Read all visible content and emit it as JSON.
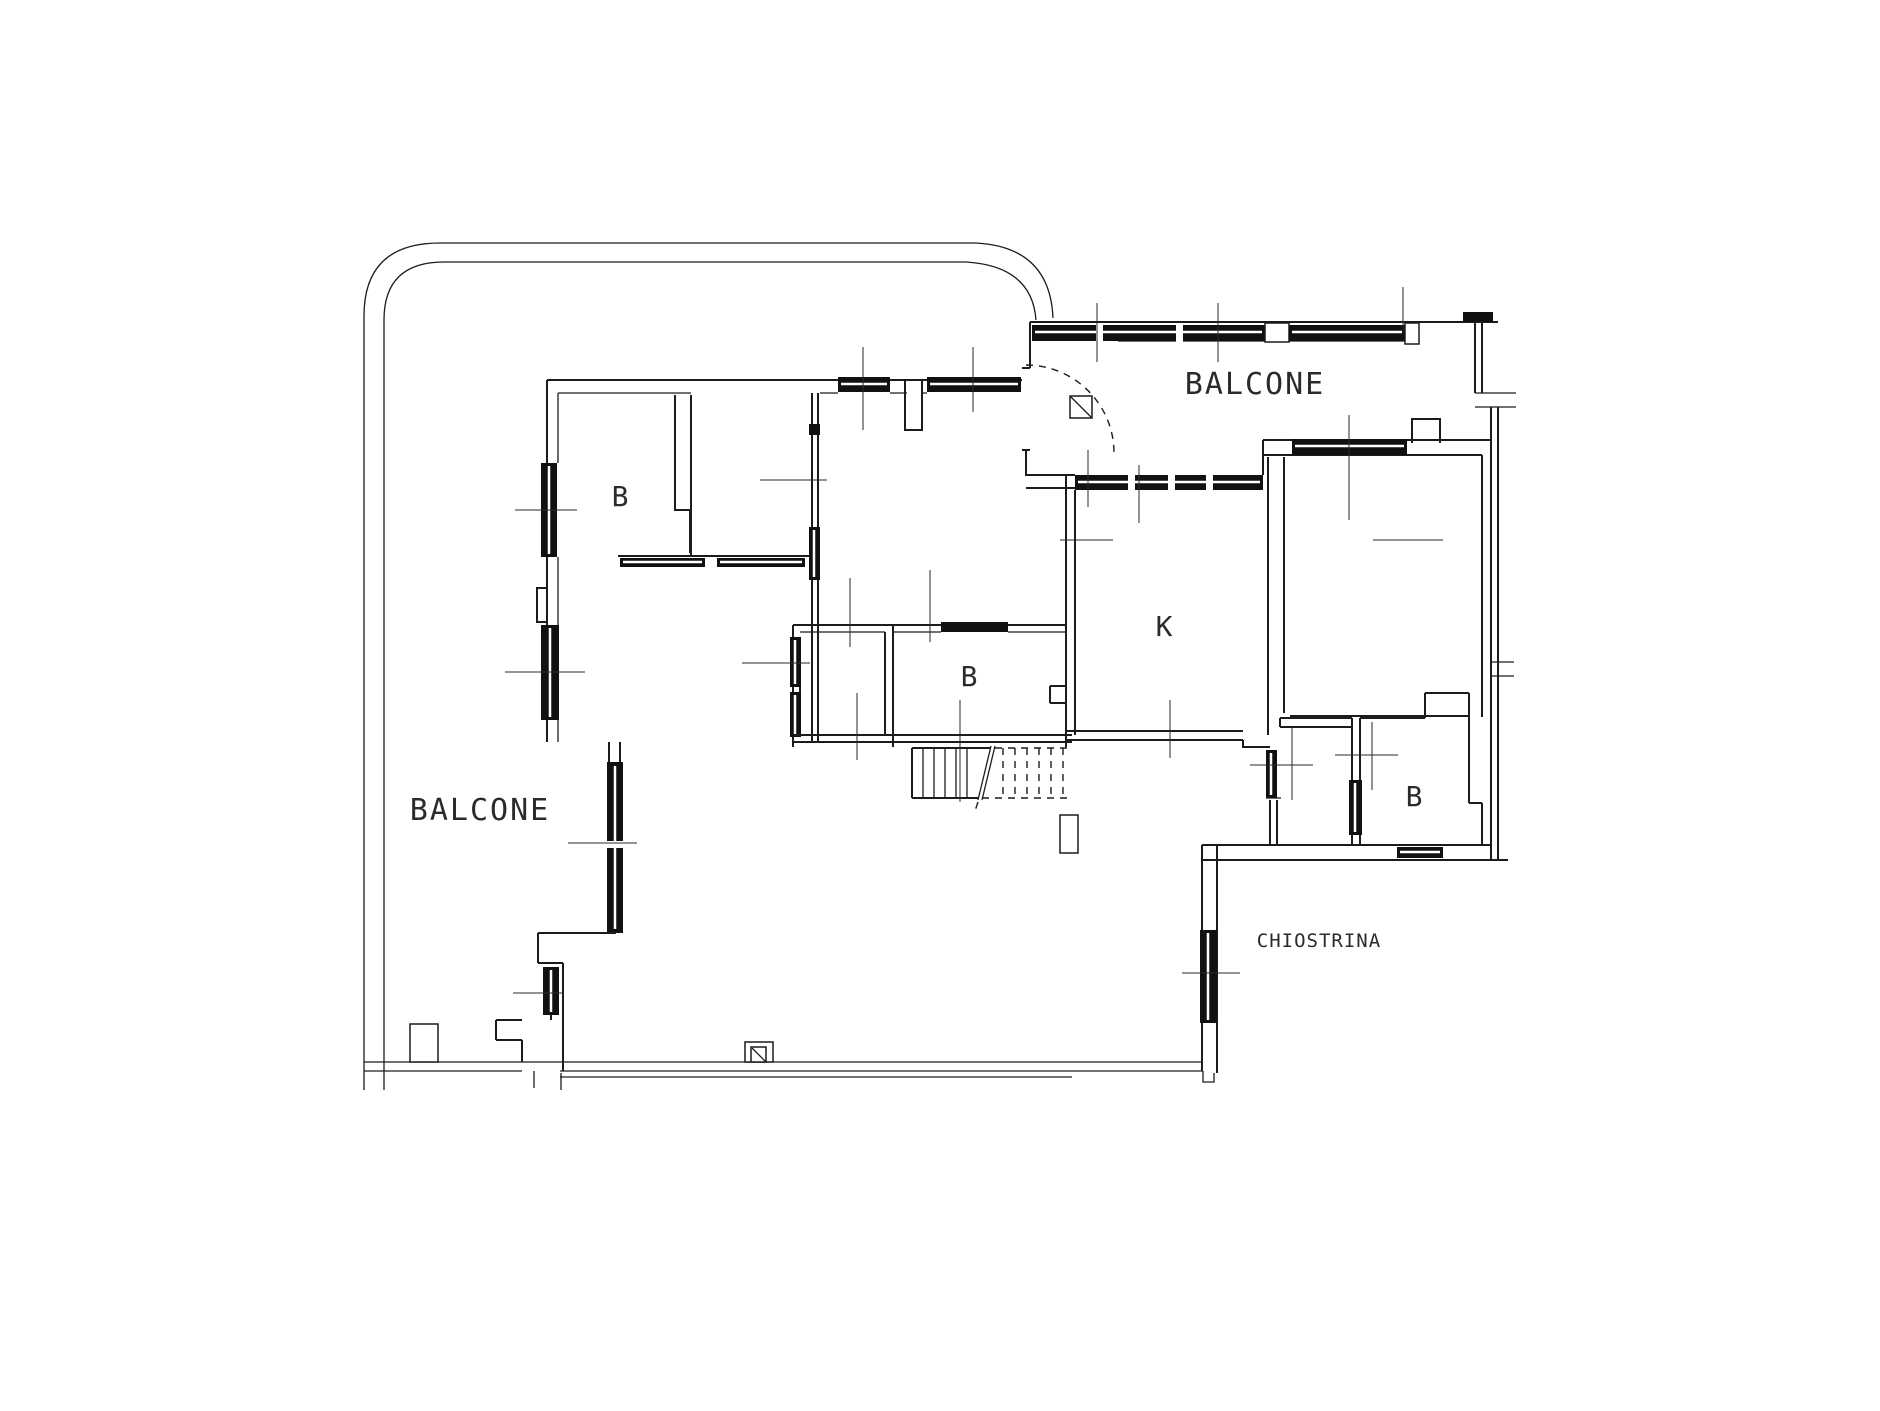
{
  "plan": {
    "type": "architectural-floor-plan",
    "background": "#ffffff",
    "line_color": "#1c1c1c",
    "labels": {
      "balcone_top": "BALCONE",
      "balcone_left": "BALCONE",
      "chiostrina": "CHIOSTRINA",
      "kitchen": "K",
      "bath_top_left": "B",
      "bath_middle": "B",
      "bath_right": "B"
    }
  }
}
